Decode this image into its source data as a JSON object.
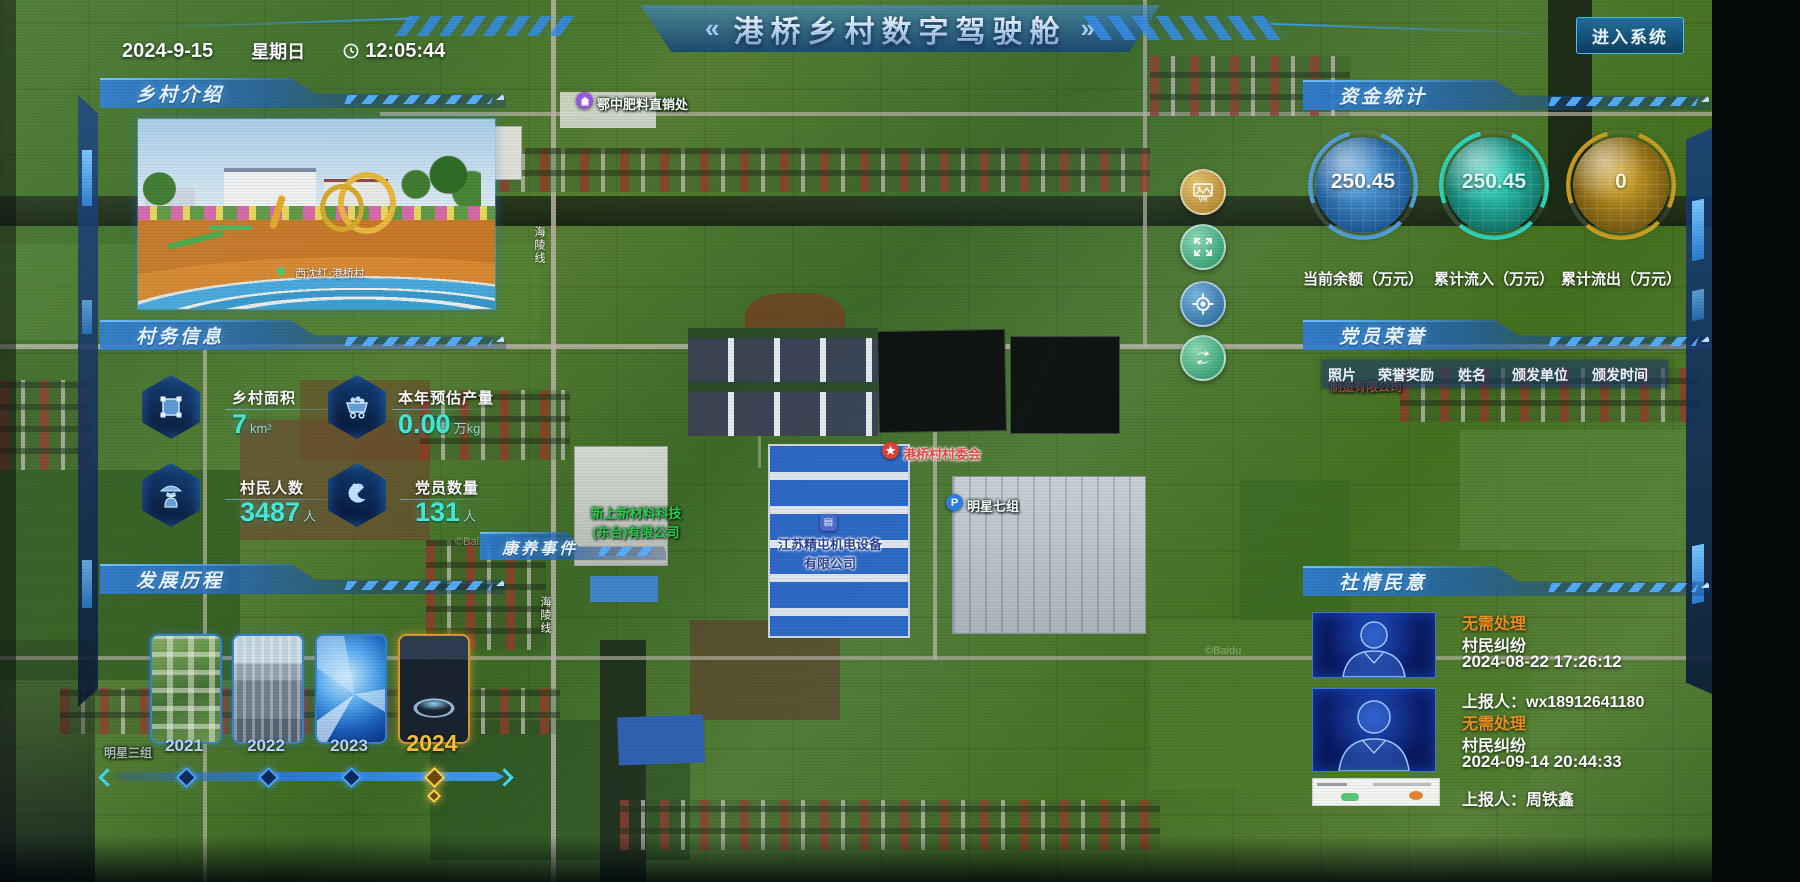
{
  "header": {
    "date": "2024-9-15",
    "weekday": "星期日",
    "time": "12:05:44",
    "chevron_left": "«",
    "title": "港桥乡村数字驾驶舱",
    "chevron_right": "»",
    "enter_button": "进入系统"
  },
  "left": {
    "intro": {
      "title": "乡村介绍",
      "photo_caption": "西沈红·港桥村"
    },
    "info": {
      "title": "村务信息",
      "stats": [
        {
          "icon": "area-icon",
          "label": "乡村面积",
          "value": "7",
          "unit": "km²"
        },
        {
          "icon": "cart-icon",
          "label": "本年预估产量",
          "value": "0.00",
          "unit": "万kg"
        },
        {
          "icon": "villager-icon",
          "label": "村民人数",
          "value": "3487",
          "unit": "人"
        },
        {
          "icon": "party-icon",
          "label": "党员数量",
          "value": "131",
          "unit": "人"
        }
      ]
    },
    "development": {
      "title": "发展历程",
      "years": [
        {
          "label": "2021"
        },
        {
          "label": "2022"
        },
        {
          "label": "2023"
        },
        {
          "label": "2024"
        }
      ]
    }
  },
  "right": {
    "funds": {
      "title": "资金统计",
      "gauges": [
        {
          "value": "250.45",
          "label": "当前余额（万元）",
          "color": "#58aae8"
        },
        {
          "value": "250.45",
          "label": "累计流入（万元）",
          "color": "#32e2c8"
        },
        {
          "value": "0",
          "label": "累计流出（万元）",
          "color": "#d9a927"
        }
      ]
    },
    "honors": {
      "title": "党员荣誉",
      "columns": [
        "照片",
        "荣誉奖励",
        "姓名",
        "颁发单位",
        "颁发时间"
      ]
    },
    "sentiment": {
      "title": "社情民意",
      "items": [
        {
          "status": "无需处理",
          "type": "村民纠纷",
          "datetime": "2024-08-22 17:26:12",
          "reporter": "上报人：wx18912641180"
        },
        {
          "status": "无需处理",
          "type": "村民纠纷",
          "datetime": "2024-09-14 20:44:33",
          "reporter": "上报人：周铁鑫"
        }
      ]
    }
  },
  "map": {
    "event_bar": "康养事件",
    "road_label": "海陵线",
    "watermark": "©Baidu",
    "pois": [
      {
        "text": "鄂中肥料直销处"
      },
      {
        "text": "港桥村村委会"
      },
      {
        "text": "江苏精屯机电设备",
        "text2": "有限公司"
      },
      {
        "text": "新上新材料科技",
        "text2": "(东台)有限公司"
      },
      {
        "text": "明星七组"
      },
      {
        "text": "明星三组"
      },
      {
        "text": "制造有限公司"
      }
    ],
    "controls": [
      {
        "name": "vr-panorama"
      },
      {
        "name": "fullscreen"
      },
      {
        "name": "locate"
      },
      {
        "name": "layer-switch"
      }
    ]
  }
}
